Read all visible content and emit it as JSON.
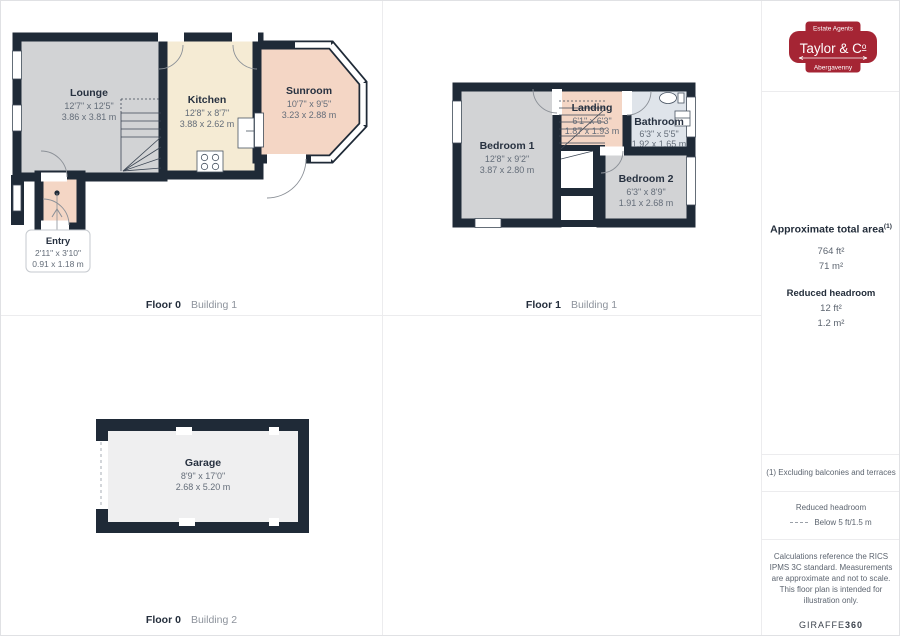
{
  "plans": [
    {
      "floor": "Floor 0",
      "building": "Building 1",
      "rooms": [
        {
          "key": "lounge",
          "name": "Lounge",
          "imperial": "12'7\" x 12'5\"",
          "metric": "3.86 x 3.81 m"
        },
        {
          "key": "kitchen",
          "name": "Kitchen",
          "imperial": "12'8\" x 8'7\"",
          "metric": "3.88 x 2.62 m"
        },
        {
          "key": "sunroom",
          "name": "Sunroom",
          "imperial": "10'7\" x 9'5\"",
          "metric": "3.23 x 2.88 m"
        },
        {
          "key": "entry",
          "name": "Entry",
          "imperial": "2'11\" x 3'10\"",
          "metric": "0.91 x 1.18 m"
        }
      ]
    },
    {
      "floor": "Floor 1",
      "building": "Building 1",
      "rooms": [
        {
          "key": "bedroom1",
          "name": "Bedroom 1",
          "imperial": "12'8\" x 9'2\"",
          "metric": "3.87 x 2.80 m"
        },
        {
          "key": "landing",
          "name": "Landing",
          "imperial": "6'1\" x 6'3\"",
          "metric": "1.87 x 1.93 m"
        },
        {
          "key": "bathroom",
          "name": "Bathroom",
          "imperial": "6'3\" x 5'5\"",
          "metric": "1.92 x 1.65 m"
        },
        {
          "key": "bedroom2",
          "name": "Bedroom 2",
          "imperial": "6'3\" x 8'9\"",
          "metric": "1.91 x 2.68 m"
        }
      ]
    },
    {
      "floor": "Floor 0",
      "building": "Building 2",
      "rooms": [
        {
          "key": "garage",
          "name": "Garage",
          "imperial": "8'9\" x 17'0\"",
          "metric": "2.68 x 5.20 m"
        }
      ]
    }
  ],
  "brand": {
    "tagline": "Estate Agents",
    "name": "Taylor & Co",
    "name_prefix": "Taylor & C",
    "name_suffix": "o",
    "location": "Abergavenny",
    "badge_color": "#a52534"
  },
  "summary": {
    "title": "Approximate total area",
    "title_marker": "(1)",
    "area_ft": "764 ft²",
    "area_m": "71 m²",
    "headroom_title": "Reduced headroom",
    "headroom_ft": "12 ft²",
    "headroom_m": "1.2 m²"
  },
  "footnotes": {
    "note": "(1) Excluding balconies and terraces",
    "legend_title": "Reduced headroom",
    "legend_label": "Below 5 ft/1.5 m",
    "disclaimer": "Calculations reference the RICS IPMS 3C standard. Measurements are approximate and not to scale. This floor plan is intended for illustration only.",
    "credit_prefix": "GIRAFFE",
    "credit_suffix": "360"
  },
  "colors": {
    "wall": "#1f2a37",
    "room_gray": "#d2d3d5",
    "room_cream": "#f5ebd4",
    "room_pink": "#f4d6c5",
    "room_blue": "#dfe4ea",
    "room_light": "#efeff0",
    "brand_red": "#a52534"
  }
}
